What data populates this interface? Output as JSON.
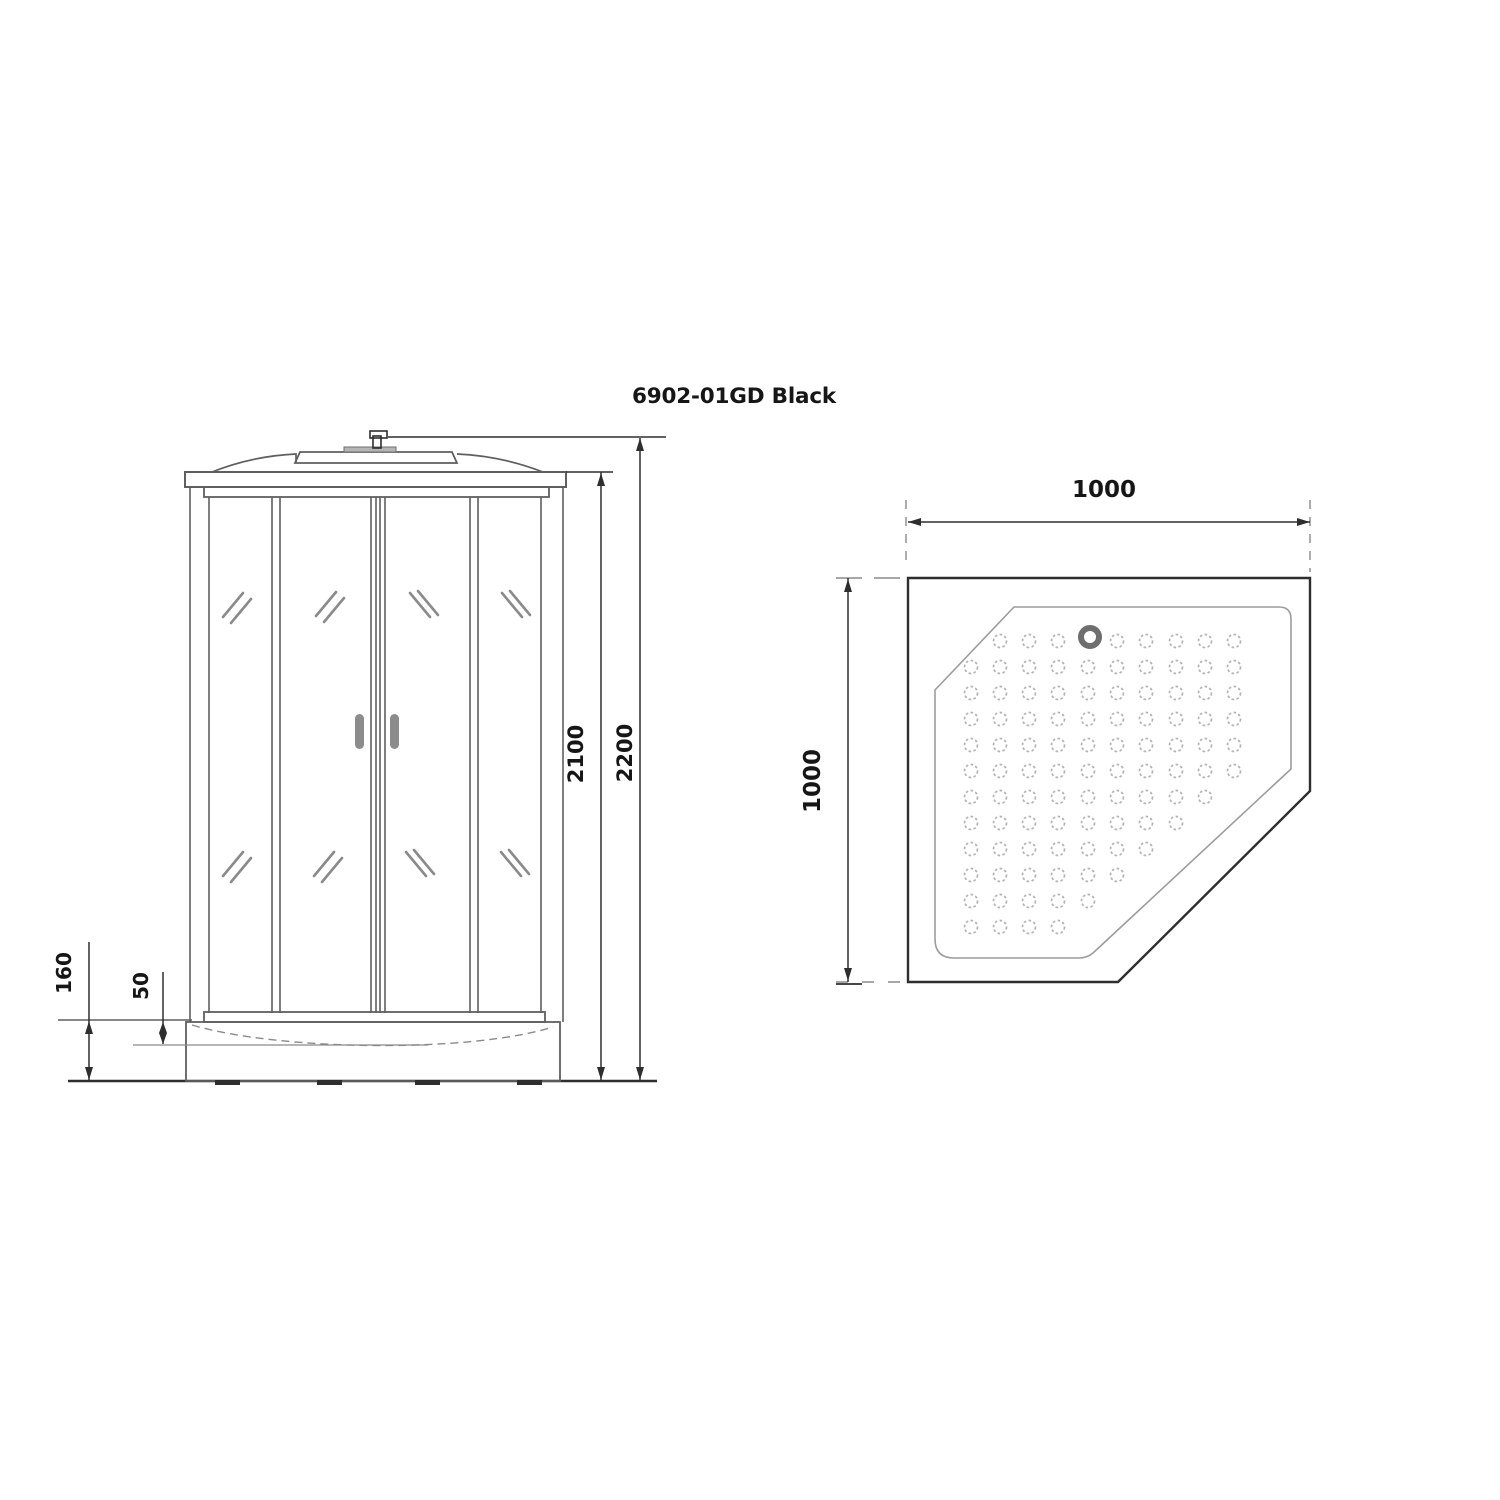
{
  "title": "6902-01GD Black",
  "front_view": {
    "label": "shower cabin front elevation",
    "dims": {
      "overall_height_mm": "2200",
      "cabin_height_mm": "2100",
      "tray_height_mm": "160",
      "tray_step_mm": "50"
    }
  },
  "plan_view": {
    "label": "pentagonal shower tray plan",
    "dims": {
      "width_mm": "1000",
      "depth_mm": "1000"
    },
    "drain": {
      "cx": 1090,
      "cy": 637,
      "r": 9,
      "ring_width": 6
    },
    "dot_grid": {
      "dot_radius": 6.5,
      "cols_x": [
        971,
        1000,
        1029,
        1058,
        1088,
        1117,
        1146,
        1176,
        1205,
        1234
      ],
      "rows_y": [
        641,
        667,
        693,
        719,
        745,
        771,
        797,
        823,
        849,
        875,
        901,
        927
      ],
      "rows": [
        [
          2,
          3,
          4,
          6,
          7,
          8,
          9,
          10
        ],
        [
          1,
          2,
          3,
          4,
          5,
          6,
          7,
          8,
          9,
          10
        ],
        [
          1,
          2,
          3,
          4,
          5,
          6,
          7,
          8,
          9,
          10
        ],
        [
          1,
          2,
          3,
          4,
          5,
          6,
          7,
          8,
          9,
          10
        ],
        [
          1,
          2,
          3,
          4,
          5,
          6,
          7,
          8,
          9,
          10
        ],
        [
          1,
          2,
          3,
          4,
          5,
          6,
          7,
          8,
          9,
          10
        ],
        [
          1,
          2,
          3,
          4,
          5,
          6,
          7,
          8,
          9
        ],
        [
          1,
          2,
          3,
          4,
          5,
          6,
          7,
          8
        ],
        [
          1,
          2,
          3,
          4,
          5,
          6,
          7
        ],
        [
          1,
          2,
          3,
          4,
          5,
          6
        ],
        [
          1,
          2,
          3,
          4,
          5
        ],
        [
          1,
          2,
          3,
          4
        ]
      ]
    }
  },
  "colors": {
    "bg": "#ffffff",
    "line": "#2e2e2e",
    "frame": "#5f5f5f",
    "mid": "#8a8a8a",
    "light": "#9c9c9c",
    "dot": "#b3b3b3",
    "handle": "#8c8c8c",
    "drain": "#6e6e6e",
    "text": "#161616"
  }
}
